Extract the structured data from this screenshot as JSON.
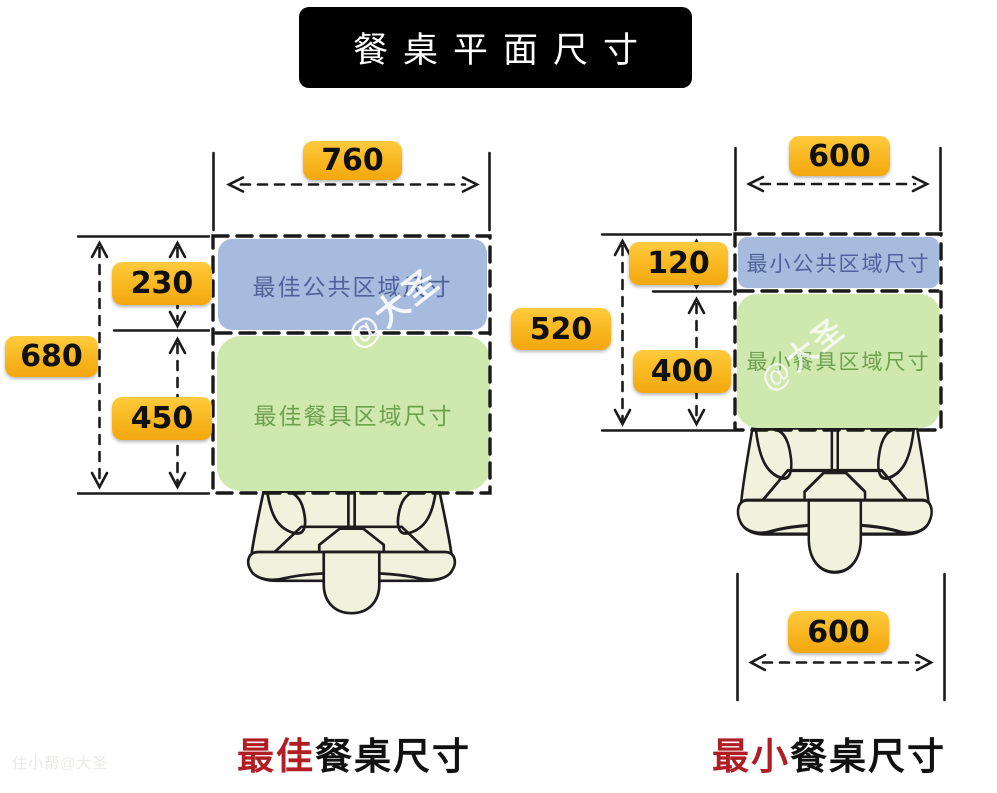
{
  "title": "餐桌平面尺寸",
  "watermarks": {
    "overlay": "@大圣",
    "corner": "住小帮@大圣"
  },
  "left_diagram": {
    "caption": {
      "highlight": "最佳",
      "rest": "餐桌尺寸"
    },
    "top_width": "760",
    "total_height": "680",
    "public_zone_height": "230",
    "dining_zone_height": "450",
    "public_zone_label": "最佳公共区域尺寸",
    "dining_zone_label": "最佳餐具区域尺寸"
  },
  "right_diagram": {
    "caption": {
      "highlight": "最小",
      "rest": "餐桌尺寸"
    },
    "top_width": "600",
    "total_height": "520",
    "public_zone_height": "120",
    "dining_zone_height": "400",
    "bottom_width": "600",
    "public_zone_label": "最小公共区域尺寸",
    "dining_zone_label": "最小餐具区域尺寸"
  },
  "colors": {
    "badge_gradient_top": "#fecb3e",
    "badge_gradient_bottom": "#f3a70e",
    "public_zone_fill": "#a7bbde",
    "public_zone_text": "#4f639b",
    "dining_zone_fill": "#cfe8ae",
    "dining_zone_text": "#6fa04f",
    "accent_red": "#b01e23",
    "line_black": "#1a1a1a",
    "chair_fill": "#f1f2dd"
  }
}
